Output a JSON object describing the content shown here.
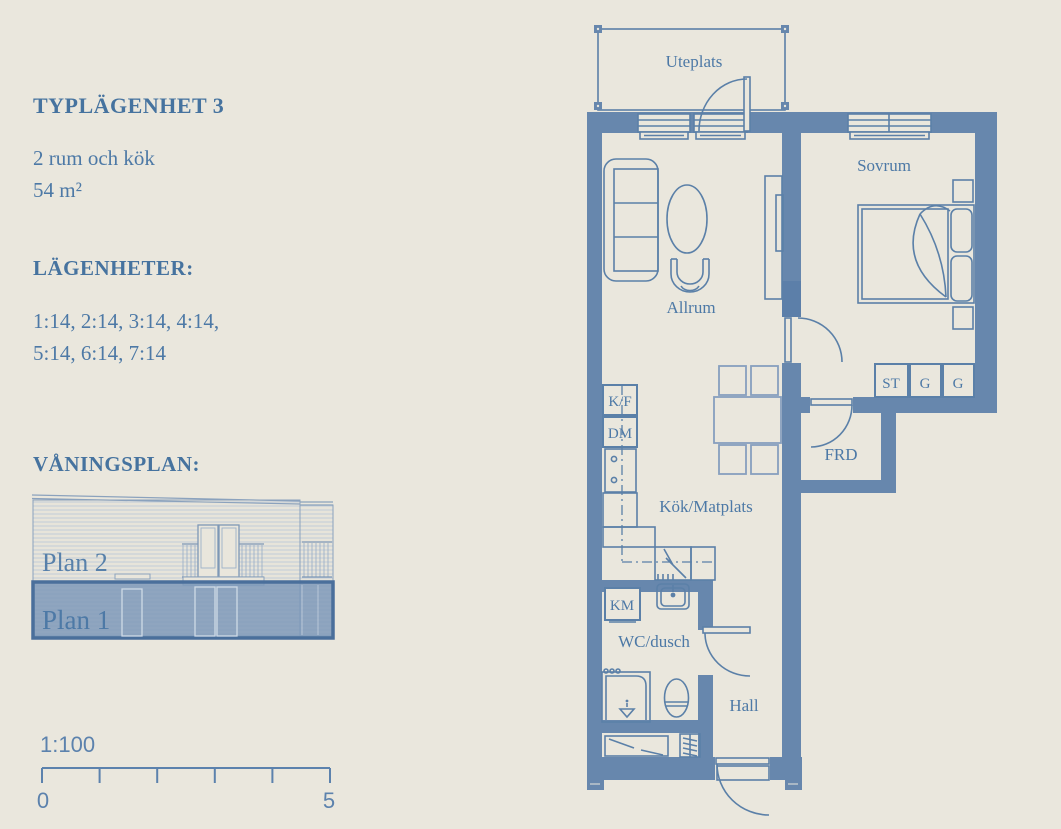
{
  "page": {
    "background": "#eae7dd",
    "accent": "#4d79a6",
    "wall_color": "#6787ad"
  },
  "info": {
    "title": "TYPLÄGENHET 3",
    "size_line1": "2 rum och kök",
    "size_line2": "54 m²",
    "apartments_heading": "LÄGENHETER:",
    "apartments_line1": "1:14, 2:14, 3:14, 4:14,",
    "apartments_line2": "5:14, 6:14, 7:14",
    "floors_heading": "VÅNINGSPLAN:",
    "plan2_label": "Plan 2",
    "plan1_label": "Plan 1",
    "scale_ratio": "1:100",
    "scale_start": "0",
    "scale_end": "5"
  },
  "plan": {
    "labels": {
      "uteplats": "Uteplats",
      "sovrum": "Sovrum",
      "allrum": "Allrum",
      "kok": "Kök/Matplats",
      "wc": "WC/dusch",
      "hall": "Hall",
      "frd": "FRD",
      "kf": "K/F",
      "dm": "DM",
      "km": "KM",
      "st": "ST",
      "g1": "G",
      "g2": "G"
    }
  }
}
